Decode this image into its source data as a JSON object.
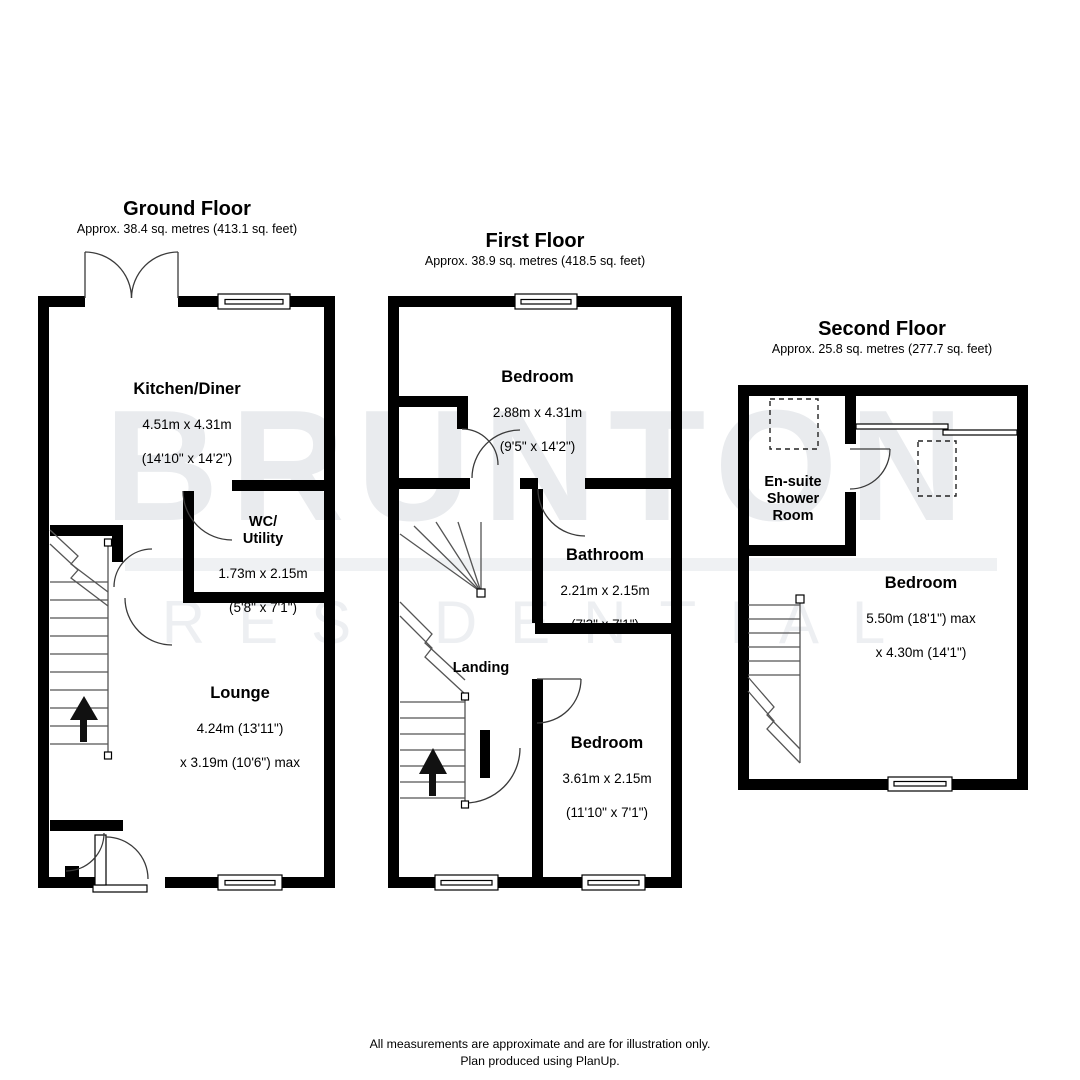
{
  "watermark": {
    "line1": "BRUNTON",
    "line2": "RESIDENTIAL"
  },
  "floors": [
    {
      "title": "Ground Floor",
      "area": "Approx. 38.4 sq. metres (413.1 sq. feet)",
      "rooms": [
        {
          "name": "Kitchen/Diner",
          "dim1": "4.51m x 4.31m",
          "dim2": "(14'10\" x 14'2\")"
        },
        {
          "name": "WC/\nUtility",
          "dim1": "1.73m x 2.15m",
          "dim2": "(5'8\" x 7'1\")"
        },
        {
          "name": "Lounge",
          "dim1": "4.24m (13'11\")",
          "dim2": "x 3.19m (10'6\") max"
        }
      ]
    },
    {
      "title": "First Floor",
      "area": "Approx. 38.9 sq. metres (418.5 sq. feet)",
      "rooms": [
        {
          "name": "Bedroom",
          "dim1": "2.88m x 4.31m",
          "dim2": "(9'5\" x 14'2\")"
        },
        {
          "name": "Bathroom",
          "dim1": "2.21m x 2.15m",
          "dim2": "(7'3\" x 7'1\")"
        },
        {
          "name": "Landing",
          "dim1": "",
          "dim2": ""
        },
        {
          "name": "Bedroom",
          "dim1": "3.61m x 2.15m",
          "dim2": "(11'10\" x 7'1\")"
        }
      ]
    },
    {
      "title": "Second Floor",
      "area": "Approx. 25.8 sq. metres (277.7 sq. feet)",
      "rooms": [
        {
          "name": "En-suite\nShower\nRoom",
          "dim1": "",
          "dim2": ""
        },
        {
          "name": "Bedroom",
          "dim1": "5.50m (18'1\") max",
          "dim2": "x 4.30m (14'1\")"
        }
      ]
    }
  ],
  "footer": {
    "line1": "All measurements are approximate and are for illustration only.",
    "line2": "Plan produced using PlanUp."
  },
  "colors": {
    "wall": "#000000",
    "watermark": "#e9ebee",
    "text": "#000000",
    "background": "#ffffff"
  }
}
